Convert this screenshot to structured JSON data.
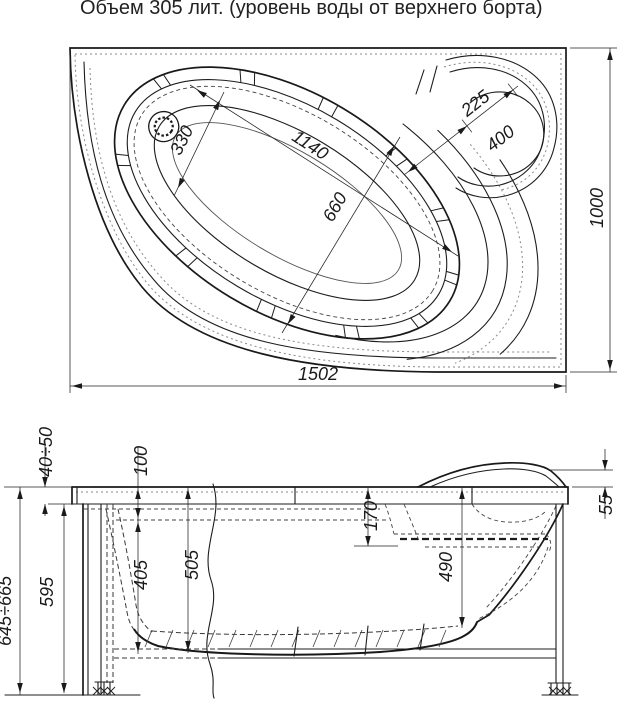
{
  "title": "Объем 305 лит. (уровень воды от верхнего борта)",
  "top_view": {
    "dims": {
      "bowl_length": "1140",
      "bowl_width": "660",
      "drain_offset": "330",
      "headrest_inner": "225",
      "headrest_outer": "400",
      "overall_width": "1000",
      "overall_length": "1502"
    }
  },
  "side_view": {
    "dims": {
      "rim_edge": "40÷50",
      "water_level": "100",
      "seat_depth": "170",
      "headrest_height": "55",
      "water_to_bottom": "405",
      "total_depth": "505",
      "depth_at_drain_end": "490",
      "body_height": "595",
      "overall_height": "645÷665"
    }
  }
}
